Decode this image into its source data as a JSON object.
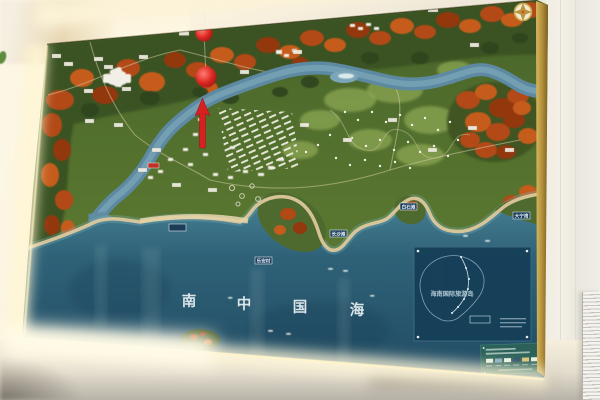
{
  "map_board": {
    "sea_name": {
      "full": "南 中 国 海",
      "chars": [
        "南",
        "中",
        "国",
        "海"
      ]
    },
    "bay_labels": [
      {
        "text": "白石滩"
      },
      {
        "text": "大宁湾"
      },
      {
        "text": "长沙滩"
      },
      {
        "text": "乐安村"
      },
      {
        "text": ""
      }
    ],
    "inset_map": {
      "title": "海南国际旅游岛"
    },
    "icons": {
      "compass": "compass-rose",
      "location_markers": "red-pompom-marker",
      "direction_marker": "red-up-arrow"
    },
    "colors": {
      "sea": "#2e6177",
      "sea_deep": "#214b63",
      "terrain_green": "#54702e",
      "autumn_orange": "#b44a15",
      "river_blue": "#6f9cb2",
      "beach_sand": "#dbc99d",
      "marker_red": "#d92020",
      "inset_panel": "#163f58",
      "legend_panel": "#2b6159",
      "backlight_glow": "#fff5d6",
      "compass_gold": "#c9a94e"
    }
  }
}
